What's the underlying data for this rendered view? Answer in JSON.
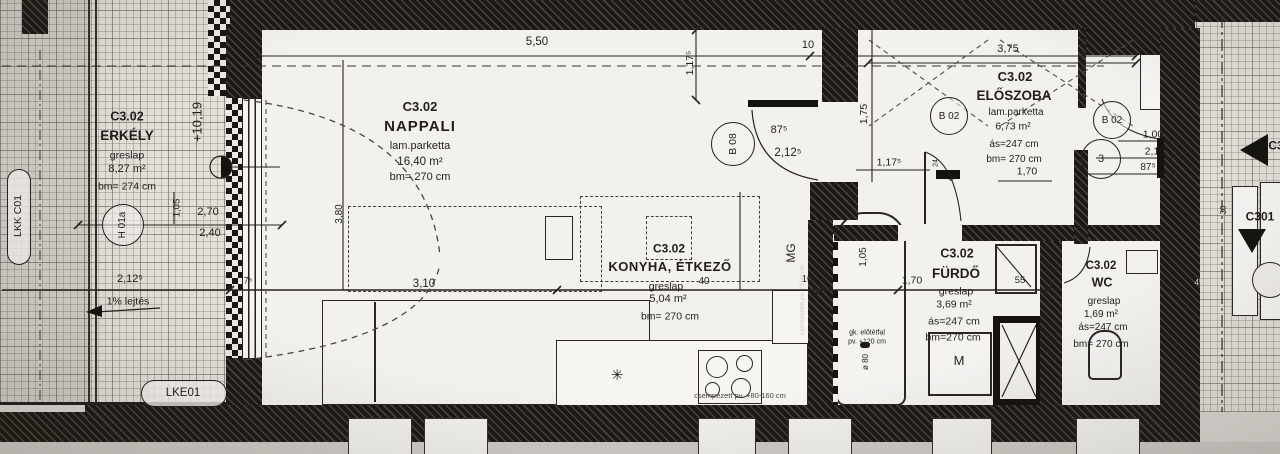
{
  "plan": {
    "unit": "C3.02",
    "rooms": {
      "erkely": {
        "code": "C3.02",
        "name": "ERKÉLY",
        "finish": "greslap",
        "area": "8,27 m²",
        "height": "bm= 274 cm"
      },
      "nappali": {
        "code": "C3.02",
        "name": "NAPPALI",
        "finish": "lam.parketta",
        "area": "16,40 m²",
        "height": "bm= 270 cm"
      },
      "konyha": {
        "code": "C3.02",
        "name": "KONYHA, ÉTKEZŐ",
        "finish": "greslap",
        "area": "5,04 m²",
        "height": "bm= 270 cm"
      },
      "eloszoba": {
        "code": "C3.02",
        "name": "ELŐSZOBA",
        "finish": "lam.parketta",
        "area": "6,73 m²",
        "ceil": "ás=247 cm",
        "height": "bm= 270 cm"
      },
      "furdo": {
        "code": "C3.02",
        "name": "FÜRDŐ",
        "finish": "greslap",
        "area": "3,69 m²",
        "ceil": "ás=247 cm",
        "height": "bm=270 cm"
      },
      "wc": {
        "code": "C3.02",
        "name": "WC",
        "finish": "greslap",
        "area": "1,69 m²",
        "ceil": "ás=247 cm",
        "height": "bm= 270 cm"
      }
    },
    "dims": {
      "t550": "5,50",
      "t10": "10",
      "t375": "3,75",
      "d875": "87⁵",
      "d2125": "2,12⁵",
      "v1175": "1,17⁵",
      "w175": "1,75",
      "h1175": "1,17⁵",
      "e270": "2,70",
      "e240": "2,40",
      "e105": "1,05",
      "e2125": "2,12⁵",
      "e75": "7⁵",
      "n310": "3,10",
      "n380": "3,80",
      "k40": "40",
      "m10": "10",
      "b105": "1,05",
      "b170": "1,70",
      "b55": "55",
      "h170": "1,70",
      "en100": "1,00",
      "en2125": "2,12⁵",
      "en875": "87⁵",
      "s24": "24",
      "s64": "64",
      "w45": "45",
      "r30": "30",
      "level": "+10,19",
      "dia80": "ø 80"
    },
    "tags": {
      "h01a": "H 01a",
      "b08": "B 08",
      "b02a": "B 02",
      "b02b": "B 02",
      "b02sub": "3",
      "lkk": "LKK C01",
      "lke": "LKE01",
      "c3": "C3",
      "c301": "C301"
    },
    "notes": {
      "slope": "1% lejtés",
      "mg": "MG",
      "m": "M",
      "gk1": "gk. előtétfal",
      "gk2": "pv. +120 cm",
      "tileBottom": "csempézett pv. +80-160 cm",
      "tileSide": "csempézett pv. +160 cm"
    },
    "symbols": {
      "sink": "✳"
    }
  }
}
